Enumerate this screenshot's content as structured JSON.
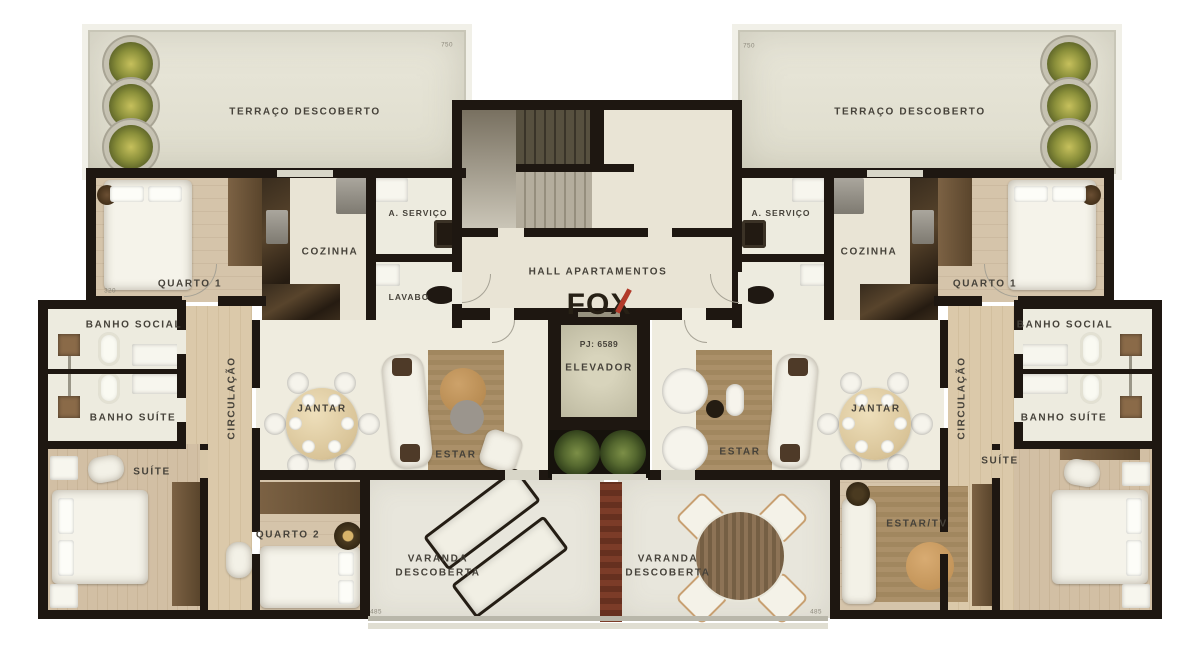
{
  "branding": {
    "logo": "FOX",
    "pj": "PJ: 6589"
  },
  "core": {
    "hall": "HALL APARTAMENTOS",
    "elevador": "ELEVADOR"
  },
  "left": {
    "terraco": "TERRAÇO DESCOBERTO",
    "quarto1": "QUARTO 1",
    "cozinha": "COZINHA",
    "servico": "A. SERVIÇO",
    "lavabo": "LAVABO",
    "banho_social": "BANHO SOCIAL",
    "banho_suite": "BANHO SUÍTE",
    "circulacao": "CIRCULAÇÃO",
    "jantar": "JANTAR",
    "estar": "ESTAR",
    "suite": "SUÍTE",
    "quarto2": "QUARTO 2",
    "varanda_line1": "VARANDA",
    "varanda_line2": "DESCOBERTA"
  },
  "right": {
    "terraco": "TERRAÇO DESCOBERTO",
    "quarto1": "QUARTO 1",
    "cozinha": "COZINHA",
    "servico": "A. SERVIÇO",
    "banho_social": "BANHO SOCIAL",
    "banho_suite": "BANHO SUÍTE",
    "circulacao": "CIRCULAÇÃO",
    "jantar": "JANTAR",
    "estar": "ESTAR",
    "suite": "SUÍTE",
    "estar_tv": "ESTAR/TV",
    "varanda_line1": "VARANDA",
    "varanda_line2": "DESCOBERTA"
  },
  "dimensions": {
    "terrace_left": "750",
    "terrace_right": "750",
    "varanda_left": "485",
    "varanda_right": "485",
    "quarto1_left": "320"
  }
}
